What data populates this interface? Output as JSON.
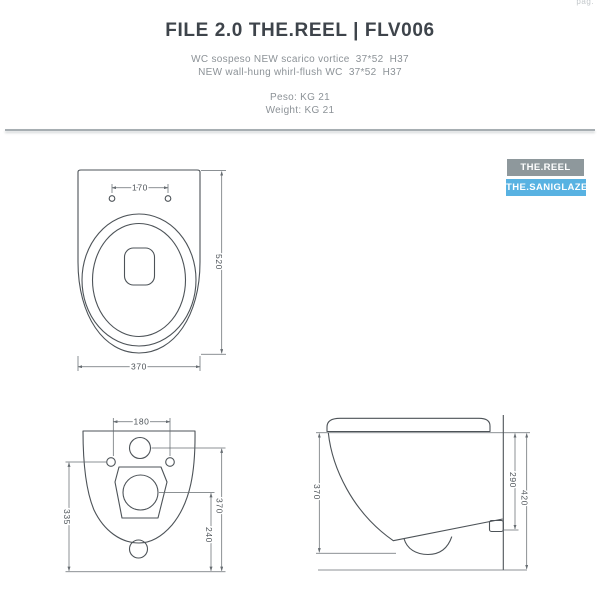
{
  "page": {
    "corner_note": "pag."
  },
  "header": {
    "title": "FILE 2.0 THE.REEL | FLV006",
    "subtitle_it": "WC sospeso NEW scarico vortice  37*52  H37",
    "subtitle_en": "NEW wall-hung whirl-flush WC  37*52  H37",
    "weight_it": "Peso: KG 21",
    "weight_en": "Weight: KG 21"
  },
  "badges": [
    {
      "label": "THE.REEL",
      "color": "#8e989c"
    },
    {
      "label": "THE.SANIGLAZE",
      "color": "#58b2e2"
    }
  ],
  "drawings": {
    "top_view": {
      "dims": {
        "hole_spacing": "170",
        "depth": "520",
        "width": "370"
      }
    },
    "bottom_view": {
      "dims": {
        "hole_spacing": "180",
        "height_left": "335",
        "drain_height": "240",
        "inlet_height": "370"
      }
    },
    "side_view": {
      "dims": {
        "front_height": "370",
        "rear_depth": "290",
        "overall_height": "420"
      }
    }
  },
  "colors": {
    "title_text": "#3e444b",
    "subtitle_text": "#8c9297",
    "divider": "#a7aeb2",
    "drawing_line": "#4d5358"
  }
}
